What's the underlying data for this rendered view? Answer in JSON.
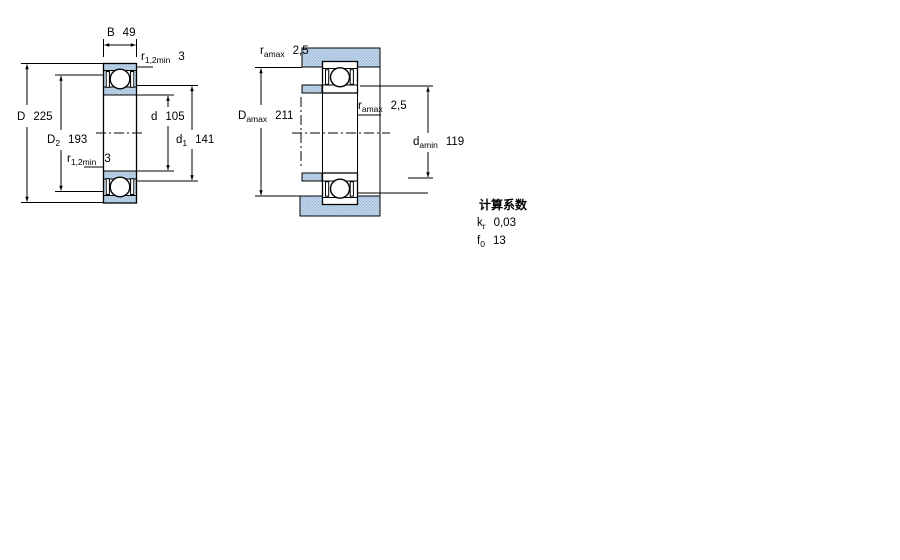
{
  "drawing_title": "bearing-technical-drawing",
  "colors": {
    "section_fill_light": "#c3d7ea",
    "section_fill_dot": "#92b4d4",
    "line": "#000000",
    "background": "#ffffff"
  },
  "left_diagram": {
    "name": "bearing-dimensions",
    "labels": {
      "B": {
        "symbol": "B",
        "value": "49"
      },
      "r12_top": {
        "symbol": "r",
        "subscript": "1,2min",
        "value": "3"
      },
      "D": {
        "symbol": "D",
        "value": "225"
      },
      "D2": {
        "symbol": "D",
        "subscript": "2",
        "value": "193"
      },
      "r12_bottom": {
        "symbol": "r",
        "subscript": "1,2min",
        "value": "3"
      },
      "d": {
        "symbol": "d",
        "value": "105"
      },
      "d1": {
        "symbol": "d",
        "subscript": "1",
        "value": "141"
      }
    }
  },
  "right_diagram": {
    "name": "abutment-dimensions",
    "labels": {
      "ra_top": {
        "symbol": "r",
        "subscript": "amax",
        "value": "2,5"
      },
      "Da": {
        "symbol": "D",
        "subscript": "amax",
        "value": "211"
      },
      "ra_mid": {
        "symbol": "r",
        "subscript": "amax",
        "value": "2,5"
      },
      "da": {
        "symbol": "d",
        "subscript": "amin",
        "value": "119"
      }
    }
  },
  "calculation_factors": {
    "title": "计算系数",
    "kr": {
      "symbol": "k",
      "subscript": "r",
      "value": "0,03"
    },
    "f0": {
      "symbol": "f",
      "subscript": "0",
      "value": "13"
    }
  }
}
